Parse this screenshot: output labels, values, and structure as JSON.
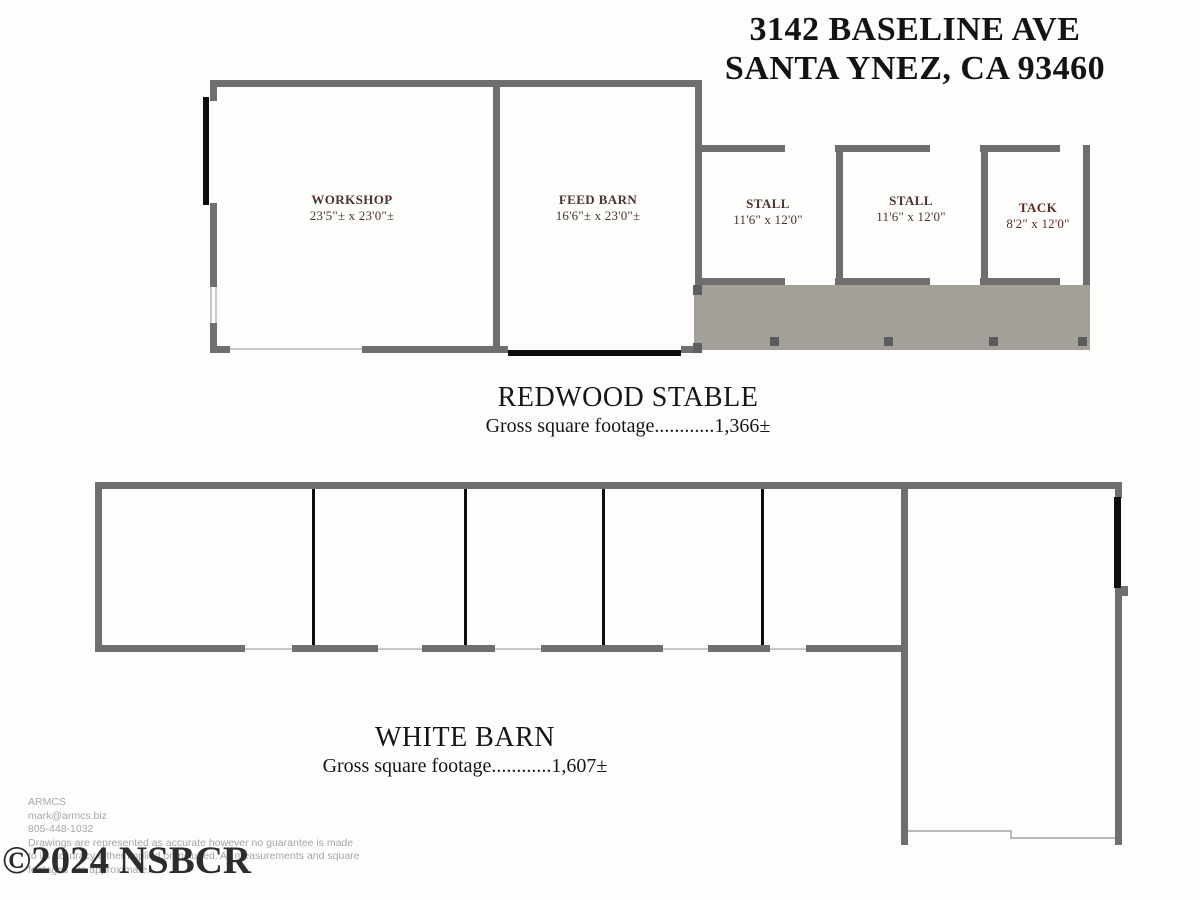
{
  "title": {
    "line1": "3142 BASELINE AVE",
    "line2": "SANTA YNEZ, CA 93460"
  },
  "redwood_stable": {
    "name": "REDWOOD STABLE",
    "footage": "Gross square footage............1,366±",
    "rooms": [
      {
        "name": "WORKSHOP",
        "dims": "23'5\"± x 23'0\"±"
      },
      {
        "name": "FEED BARN",
        "dims": "16'6\"± x 23'0\"±"
      },
      {
        "name": "STALL",
        "dims": "11'6\" x 12'0\""
      },
      {
        "name": "STALL",
        "dims": "11'6\" x 12'0\""
      },
      {
        "name": "TACK",
        "dims": "8'2\" x 12'0\""
      }
    ]
  },
  "white_barn": {
    "name": "WHITE BARN",
    "footage": "Gross square footage............1,607±"
  },
  "credits": {
    "company": "ARMCS",
    "email": "mark@armcs.biz",
    "phone": "805-448-1032",
    "disclaimer_line1": "Drawings are represented as accurate however no guarantee is made",
    "disclaimer_line2": "to its accuracy either implied or included. All measurements and square",
    "disclaimer_line3": "footages are approximate."
  },
  "watermark": {
    "text": "©2024 NSBCR"
  },
  "colors": {
    "wall": "#706f6d",
    "door_marker": "#0e0e0e",
    "porch_fill": "#a3a099",
    "post": "#5c5b5e",
    "room_label": "#4b342e",
    "tack_label": "#5d2b24",
    "heading_text": "#131313",
    "credits_text": "#a6a6a6"
  }
}
